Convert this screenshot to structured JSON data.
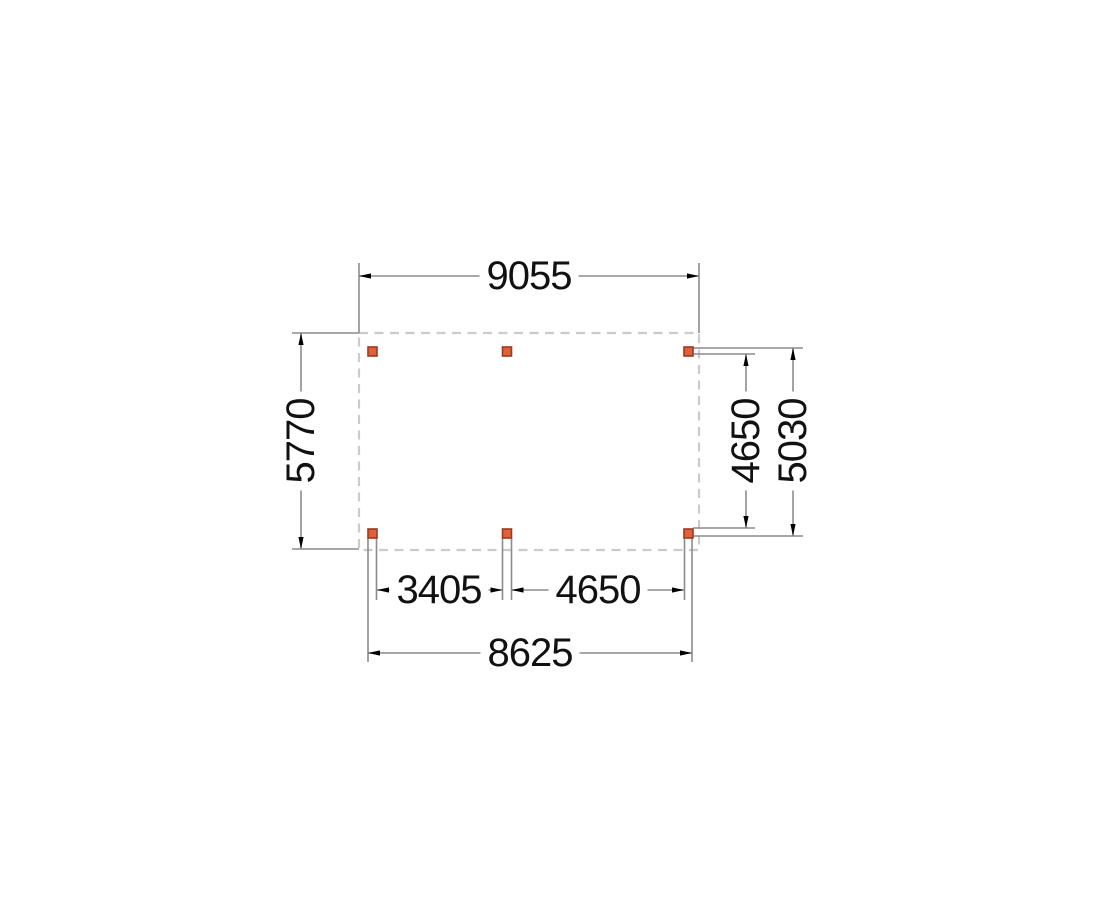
{
  "drawing": {
    "type": "plan-view-technical-drawing",
    "dimensions": {
      "width_top": "9055",
      "height_left": "5770",
      "inner_height_right": "4650",
      "outer_height_right": "5030",
      "span_bottom_left": "3405",
      "span_bottom_right": "4650",
      "width_bottom": "8625"
    },
    "posts": {
      "count": 6,
      "rows": 2,
      "columns": 3,
      "marker": "orange-square"
    }
  },
  "colors": {
    "line": "#8c8c8c",
    "outline": "#cbcbcb",
    "arrow": "#000000",
    "post_fill": "#e0603a",
    "post_border": "#9c3a1f",
    "text": "#111111",
    "background": "#ffffff"
  }
}
